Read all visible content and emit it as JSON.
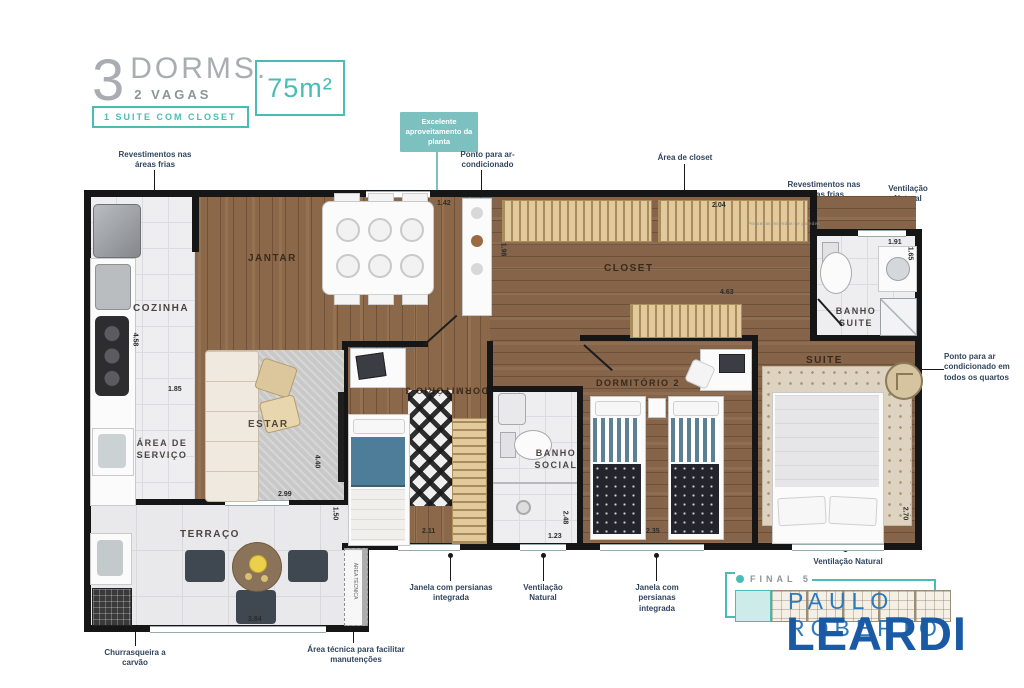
{
  "header": {
    "number": "3",
    "dorms": "DORMS.",
    "vagas": "2 VAGAS",
    "badge": "1 SUITE COM CLOSET",
    "area": "75m²"
  },
  "callout": "Excelente aproveitamento da planta",
  "annotations": {
    "revest_left": "Revestimentos nas áreas frias",
    "ponto_ar_top": "Ponto para ar-condicionado",
    "area_closet": "Área de closet",
    "revest_right": "Revestimentos nas áreas frias",
    "vent_right": "Ventilação Natural",
    "ponto_ar_quartos": "Ponto para ar condicionado em todos os quartos",
    "janela_1": "Janela com persianas integrada",
    "vent_1": "Ventilação Natural",
    "janela_2": "Janela com persianas integrada",
    "vent_suite": "Ventilação Natural",
    "churrasqueira": "Churrasqueira a carvão",
    "area_tecnica": "Área técnica para facilitar manutenções",
    "fine_print": "Pequenas emendas de paredes"
  },
  "rooms": {
    "jantar": "JANTAR",
    "cozinha": "COZINHA",
    "estar": "ESTAR",
    "area_servico": "ÁREA DE SERVIÇO",
    "terraco": "TERRAÇO",
    "dorm3": "DORMITÓRIO 3",
    "banho_social": "BANHO SOCIAL",
    "dorm2": "DORMITÓRIO 2",
    "closet": "CLOSET",
    "banho_suite": "BANHO SUITE",
    "suite": "SUITE",
    "area_tecnica_strip": "ÁREA TÉCNICA"
  },
  "dims": {
    "d1": "1.42",
    "d2": "2.04",
    "d3": "4.63",
    "d4": "1.91",
    "d5": "1.65",
    "d6": "4.58",
    "d7": "1.85",
    "d8": "4.40",
    "d9": "2.99",
    "d10": "1.50",
    "d11": "2.11",
    "d12": "1.23",
    "d13": "2.48",
    "d14": "2.35",
    "d15": "2.70",
    "d16": "3.84",
    "d17": "1.98"
  },
  "keyplan": {
    "label": "FINAL 5"
  },
  "logo": {
    "top": "PAULO ROBERTO",
    "name": "LEARDI"
  },
  "colors": {
    "teal": "#49bdb5",
    "logo_blue": "#1a5aa5",
    "logo_light_blue": "#2e79bd",
    "annotation": "#31455e",
    "wood": "#8b6849"
  }
}
